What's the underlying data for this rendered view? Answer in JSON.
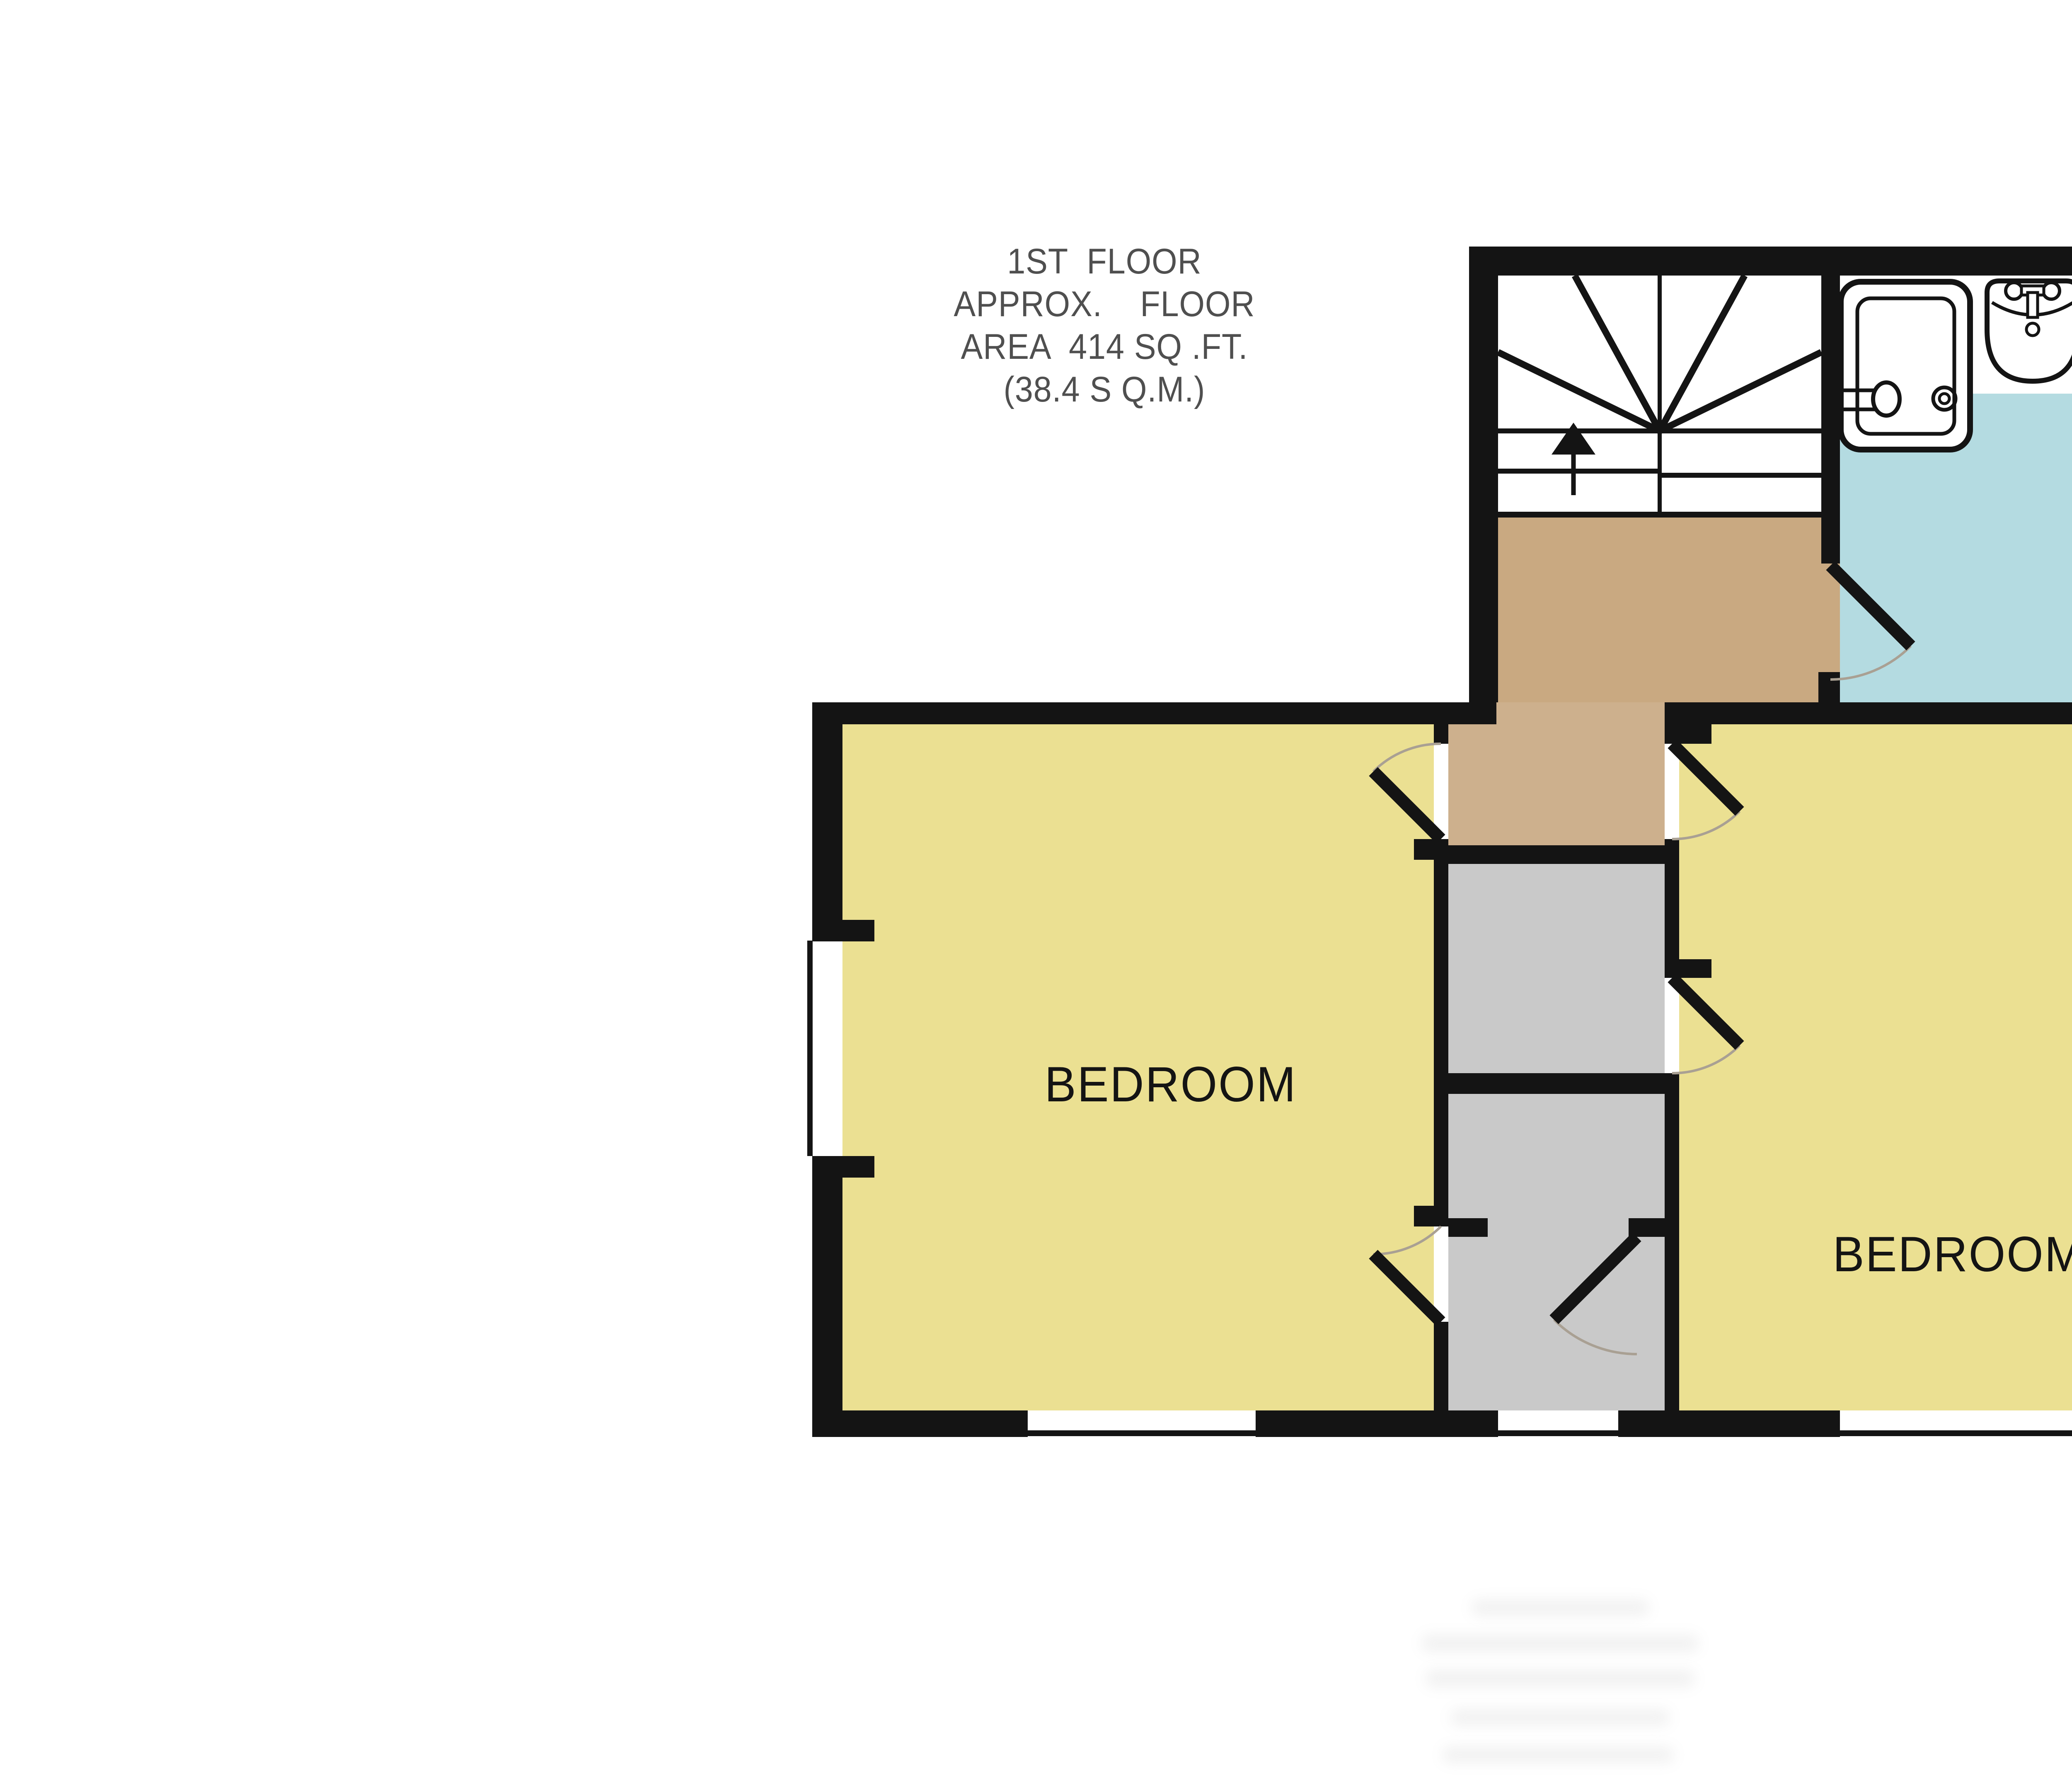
{
  "title": {
    "line1": "1ST  FLOOR",
    "line2": "APPROX.    FLOOR",
    "line3": "AREA  414 SQ .FT.",
    "line4": "(38.4 S Q.M.)"
  },
  "floor_info": {
    "floor_name": "1ST FLOOR",
    "approx_area_sqft": "414",
    "approx_area_sqm": "38.4"
  },
  "rooms": {
    "left_bedroom": "BEDROOM",
    "right_bedroom": "BEDROOM",
    "bathroom": "",
    "landing": "",
    "stairs": ""
  },
  "fixtures": [
    "staircase-with-up-arrow",
    "shower-unit",
    "pedestal-sink",
    "bathtub",
    "toilet",
    "door-swing-left-bedroom-upper",
    "door-swing-left-bedroom-lower",
    "door-swing-right-bedroom-upper",
    "door-swing-right-bedroom-mid",
    "door-swing-bathroom",
    "door-swing-closet",
    "window-left-wall",
    "window-right-wall",
    "window-bottom-left",
    "window-bottom-middle",
    "window-bottom-right"
  ],
  "colors": {
    "wall": "#141414",
    "bedroom_floor": "#ebe092",
    "bathroom_floor": "#b4dbe1",
    "landing_floor": "#c9a981",
    "hall_floor": "#cdb08d",
    "closet_floor": "#c9c9c9",
    "header_text": "#4f4f4f",
    "background": "#ffffff"
  }
}
